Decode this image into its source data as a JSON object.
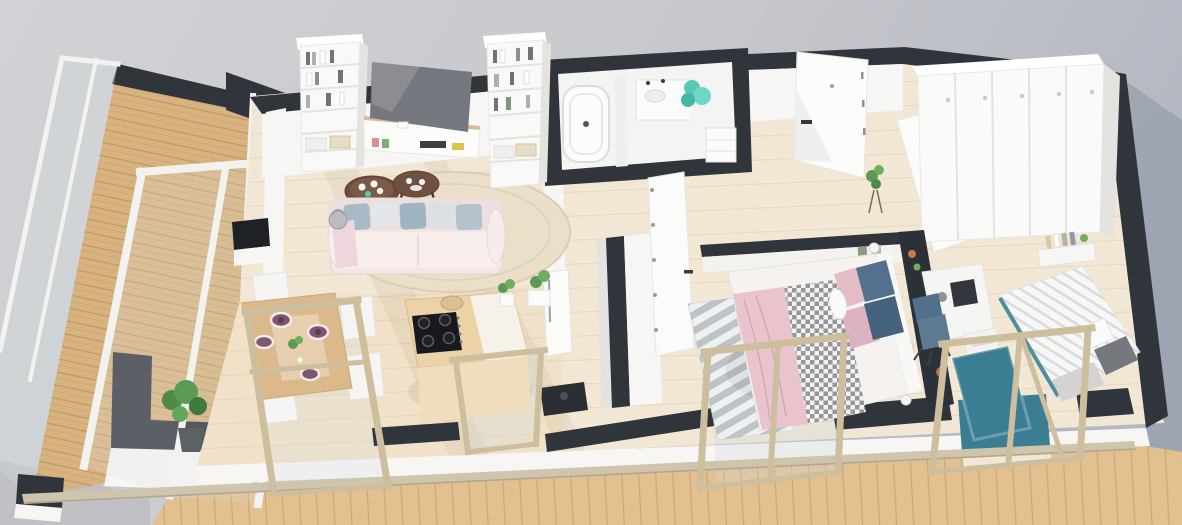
{
  "meta": {
    "title": "Apartment 3D floor plan render",
    "description": "High-angle 3D render of a scandinavian-style apartment floor plan with white walls, dark wall caps, light wood floors, a wrap-around balcony with glass railing, living room, dining area, kitchen island, bathroom, hallway, wardrobe corner, bedroom and kids room"
  },
  "scene": {
    "type": "3d-floorplan-render",
    "style": "scandinavian apartment, white walls, light wood floors, dark grey wall tops",
    "camera": "high-angle isometric, slightly rotated clockwise",
    "rooms": [
      {
        "id": "balcony",
        "label": "Balcony / terrace",
        "features": [
          "wood plank decking",
          "glass railing",
          "dark parapet caps",
          "green potted plant",
          "leaning white door frames"
        ]
      },
      {
        "id": "living-room",
        "label": "Living room",
        "features": [
          "two tall white bookcases with books and baskets",
          "flat-screen TV on white media bench",
          "round beige rug",
          "two round dark-wood coffee tables with cups",
          "light pink sofa with blue-grey cushions",
          "grey basket",
          "black window-side console"
        ]
      },
      {
        "id": "dining-area",
        "label": "Dining area",
        "features": [
          "light wood dining table set for four",
          "plum-coloured plates",
          "white chairs",
          "green potted plant"
        ]
      },
      {
        "id": "kitchen",
        "label": "Kitchen",
        "features": [
          "wood island counter",
          "black gas cooktop with four burners",
          "wicker basket",
          "potted plant",
          "white fridge column",
          "dark floor appliance"
        ]
      },
      {
        "id": "bathroom",
        "label": "Bathroom",
        "features": [
          "white bathtub",
          "vanity with sink",
          "teal plant",
          "open shelf",
          "dark-capped enclosure walls"
        ]
      },
      {
        "id": "hallway",
        "label": "Hallway",
        "features": [
          "open white interior door with hinges",
          "white entrance door with black handle",
          "small plant on stand"
        ]
      },
      {
        "id": "wardrobe-corner",
        "label": "Wardrobe corner",
        "features": [
          "five-door white wardrobe with round knobs",
          "open white door"
        ]
      },
      {
        "id": "bedroom",
        "label": "Bedroom",
        "features": [
          "double bed with pink and checked blankets",
          "blue and pink cushions",
          "white lumbar roll",
          "dark accent wall with decor shelf",
          "grey striped rug",
          "two bedside lamps",
          "two small wall pictures"
        ]
      },
      {
        "id": "kids-room",
        "label": "Kids room / study",
        "features": [
          "white desk with dark monitor and grey lamp",
          "blue desk chair",
          "white drawer unit",
          "single bed with striped white duvet",
          "dark grey pillow",
          "teal rug",
          "wall shelf with books"
        ]
      }
    ],
    "windows": [
      "dining floor-to-ceiling window",
      "kitchen window",
      "bedroom double window",
      "kids-room glass door"
    ],
    "exterior": [
      "wood terrace strip along bottom",
      "beige hand rail",
      "grey ground with cast shadow at right"
    ]
  },
  "colors": {
    "bgLeft": "#d0d0d4",
    "bgRight": "#b7bbc5",
    "wallTop": "#30353c",
    "wallWhite": "#f7f6f4",
    "wallShade": "#e4e3e0",
    "floor": "#f2e7d4",
    "deck": "#d9b37f",
    "terrace": "#e2c090",
    "railTan": "#cfc4ac",
    "frameTan": "#cdbf9e",
    "accentDark": "#2c3137",
    "sofa": "#f3e6e5",
    "rugRound": "#ebdfc9",
    "tableWood": "#dcb98b",
    "coffeeDark": "#6b4d3c",
    "platePurple": "#7f5574",
    "cooktop": "#17191d",
    "teal": "#58c9b4",
    "tealRug": "#3b7e93",
    "bedPink": "#e9c4cd",
    "pillowBlue": "#53718c",
    "pillowPink": "#e3bcc6",
    "chairBlue": "#5e7a92",
    "plantGreen": "#5a9a55",
    "tvGray": "#75787f"
  }
}
